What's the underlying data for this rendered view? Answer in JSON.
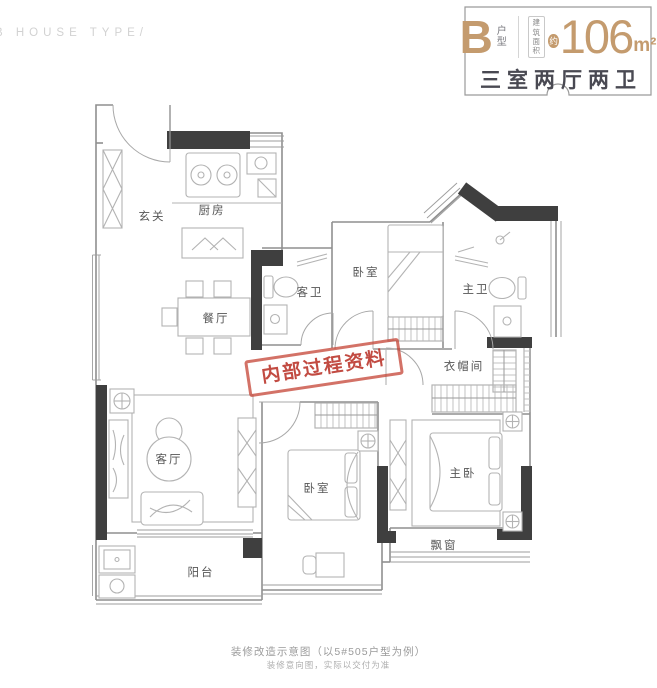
{
  "watermark": "B HOUSE TYPE/",
  "header": {
    "type_letter": "B",
    "type_label_line1": "户",
    "type_label_line2": "型",
    "area_label_line1": "建筑",
    "area_label_line2": "面积",
    "approx": "约",
    "area_value": "106",
    "area_unit": "m²",
    "layout_summary": "三室两厅两卫",
    "accent_color": "#C49B6E",
    "summary_color": "#494952"
  },
  "floorplan": {
    "rooms": {
      "entry": "玄关",
      "kitchen": "厨房",
      "dining": "餐厅",
      "guest_bath": "客卫",
      "bedroom_top": "卧室",
      "master_bath": "主卫",
      "cloakroom": "衣帽间",
      "living": "客厅",
      "bedroom_bottom": "卧室",
      "master_bedroom": "主卧",
      "bay_window": "飘窗",
      "balcony": "阳台"
    },
    "stamp_text": "内部过程资料",
    "stamp_color": "#C0392B"
  },
  "footer": {
    "caption": "装修改造示意图（以5#505户型为例）",
    "note": "装修意向图，实际以交付为准"
  }
}
